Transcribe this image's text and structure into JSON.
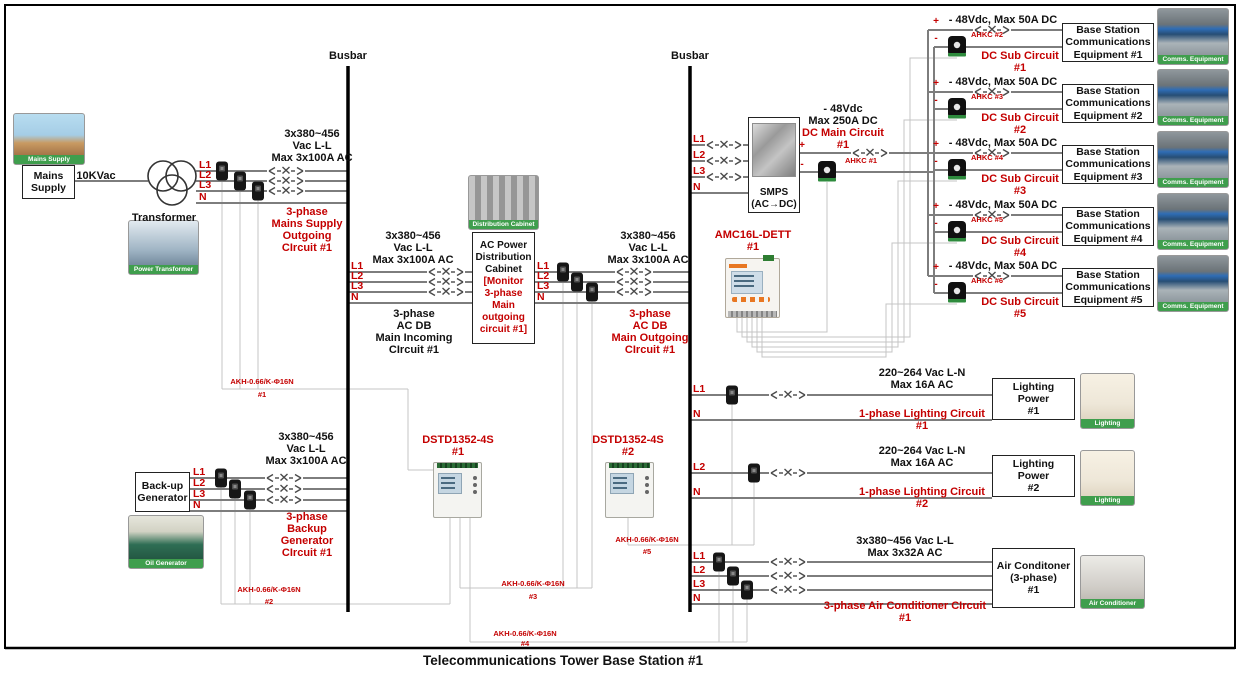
{
  "title": "Telecommunications Tower Base Station #1",
  "busbars": {
    "left": "Busbar",
    "right": "Busbar"
  },
  "phases": {
    "l1": "L1",
    "l2": "L2",
    "l3": "L3",
    "n": "N"
  },
  "polarity": {
    "plus": "+",
    "minus": "-"
  },
  "mains": {
    "photo_caption": "Mains Supply",
    "box": "Mains\nSupply",
    "voltage": "10KVac",
    "transformer_label": "Transformer",
    "transformer_photo_caption": "Power Transformer",
    "spec": "3x380~456\nVac L-L\nMax 3x100A AC",
    "circuit": "3-phase\nMains Supply\nOutgoing\nCIrcuit #1",
    "sensor": "AKH-0.66/K-Φ16N",
    "sensor_num": "#1"
  },
  "incoming": {
    "spec": "3x380~456\nVac L-L\nMax 3x100A AC",
    "circuit": "3-phase\nAC DB\nMain Incoming\nCIrcuit #1"
  },
  "cabinet": {
    "photo_caption": "Distribution Cabinet",
    "title": "AC Power\nDistribution\nCabinet",
    "subtitle": "[Monitor\n3-phase\nMain\noutgoing\ncircuit #1]"
  },
  "outgoing": {
    "spec": "3x380~456\nVac L-L\nMax 3x100A AC",
    "circuit": "3-phase\nAC DB\nMain Outgoing\nCIrcuit #1"
  },
  "generator": {
    "box": "Back-up\nGenerator",
    "photo_caption": "Oil Generator",
    "spec": "3x380~456\nVac L-L\nMax 3x100A AC",
    "circuit": "3-phase\nBackup\nGenerator\nCIrcuit #1",
    "sensor": "AKH-0.66/K-Φ16N",
    "sensor_num": "#2"
  },
  "meters": {
    "dstd1": {
      "label": "DSTD1352-4S",
      "num": "#1"
    },
    "dstd2": {
      "label": "DSTD1352-4S",
      "num": "#2"
    },
    "amc16": {
      "label": "AMC16L-DETT",
      "num": "#1"
    },
    "akh3": {
      "label": "AKH-0.66/K-Φ16N",
      "num": "#3"
    },
    "akh4": {
      "label": "AKH-0.66/K-Φ16N",
      "num": "#4"
    },
    "akh5": {
      "label": "AKH-0.66/K-Φ16N",
      "num": "#5"
    }
  },
  "smps": {
    "label": "SMPS\n(AC→DC)",
    "dc_spec": "- 48Vdc\nMax 250A DC",
    "dc_circuit": "DC Main Circuit\n#1",
    "sensor": "AHKC #1"
  },
  "dc_subs": [
    {
      "spec": "- 48Vdc, Max 50A DC",
      "sensor": "AHKC #2",
      "circuit": "DC Sub Circuit\n#1",
      "equipment": "Base Station\nCommunications\nEquipment #1",
      "photo_caption": "Comms. Equipment"
    },
    {
      "spec": "- 48Vdc, Max 50A DC",
      "sensor": "AHKC #3",
      "circuit": "DC Sub Circuit\n#2",
      "equipment": "Base Station\nCommunications\nEquipment #2",
      "photo_caption": "Comms. Equipment"
    },
    {
      "spec": "- 48Vdc, Max 50A DC",
      "sensor": "AHKC #4",
      "circuit": "DC Sub Circuit\n#3",
      "equipment": "Base Station\nCommunications\nEquipment #3",
      "photo_caption": "Comms. Equipment"
    },
    {
      "spec": "- 48Vdc, Max 50A DC",
      "sensor": "AHKC #5",
      "circuit": "DC Sub Circuit\n#4",
      "equipment": "Base Station\nCommunications\nEquipment #4",
      "photo_caption": "Comms. Equipment"
    },
    {
      "spec": "- 48Vdc, Max 50A DC",
      "sensor": "AHKC #6",
      "circuit": "DC Sub Circuit\n#5",
      "equipment": "Base Station\nCommunications\nEquipment #5",
      "photo_caption": "Comms. Equipment"
    }
  ],
  "lighting": [
    {
      "phase": "L1",
      "neutral": "N",
      "spec": "220~264 Vac L-N\nMax 16A AC",
      "circuit": "1-phase Lighting Circuit\n#1",
      "box": "Lighting\nPower\n#1",
      "photo_caption": "Lighting"
    },
    {
      "phase": "L2",
      "neutral": "N",
      "spec": "220~264 Vac L-N\nMax 16A AC",
      "circuit": "1-phase Lighting Circuit\n#2",
      "box": "Lighting\nPower\n#2",
      "photo_caption": "Lighting"
    }
  ],
  "aircon": {
    "spec": "3x380~456 Vac L-L\nMax 3x32A AC",
    "circuit": "3-phase Air Conditioner CIrcuit\n#1",
    "box": "Air Conditoner\n(3-phase)\n#1",
    "photo_caption": "Air Conditioner"
  }
}
